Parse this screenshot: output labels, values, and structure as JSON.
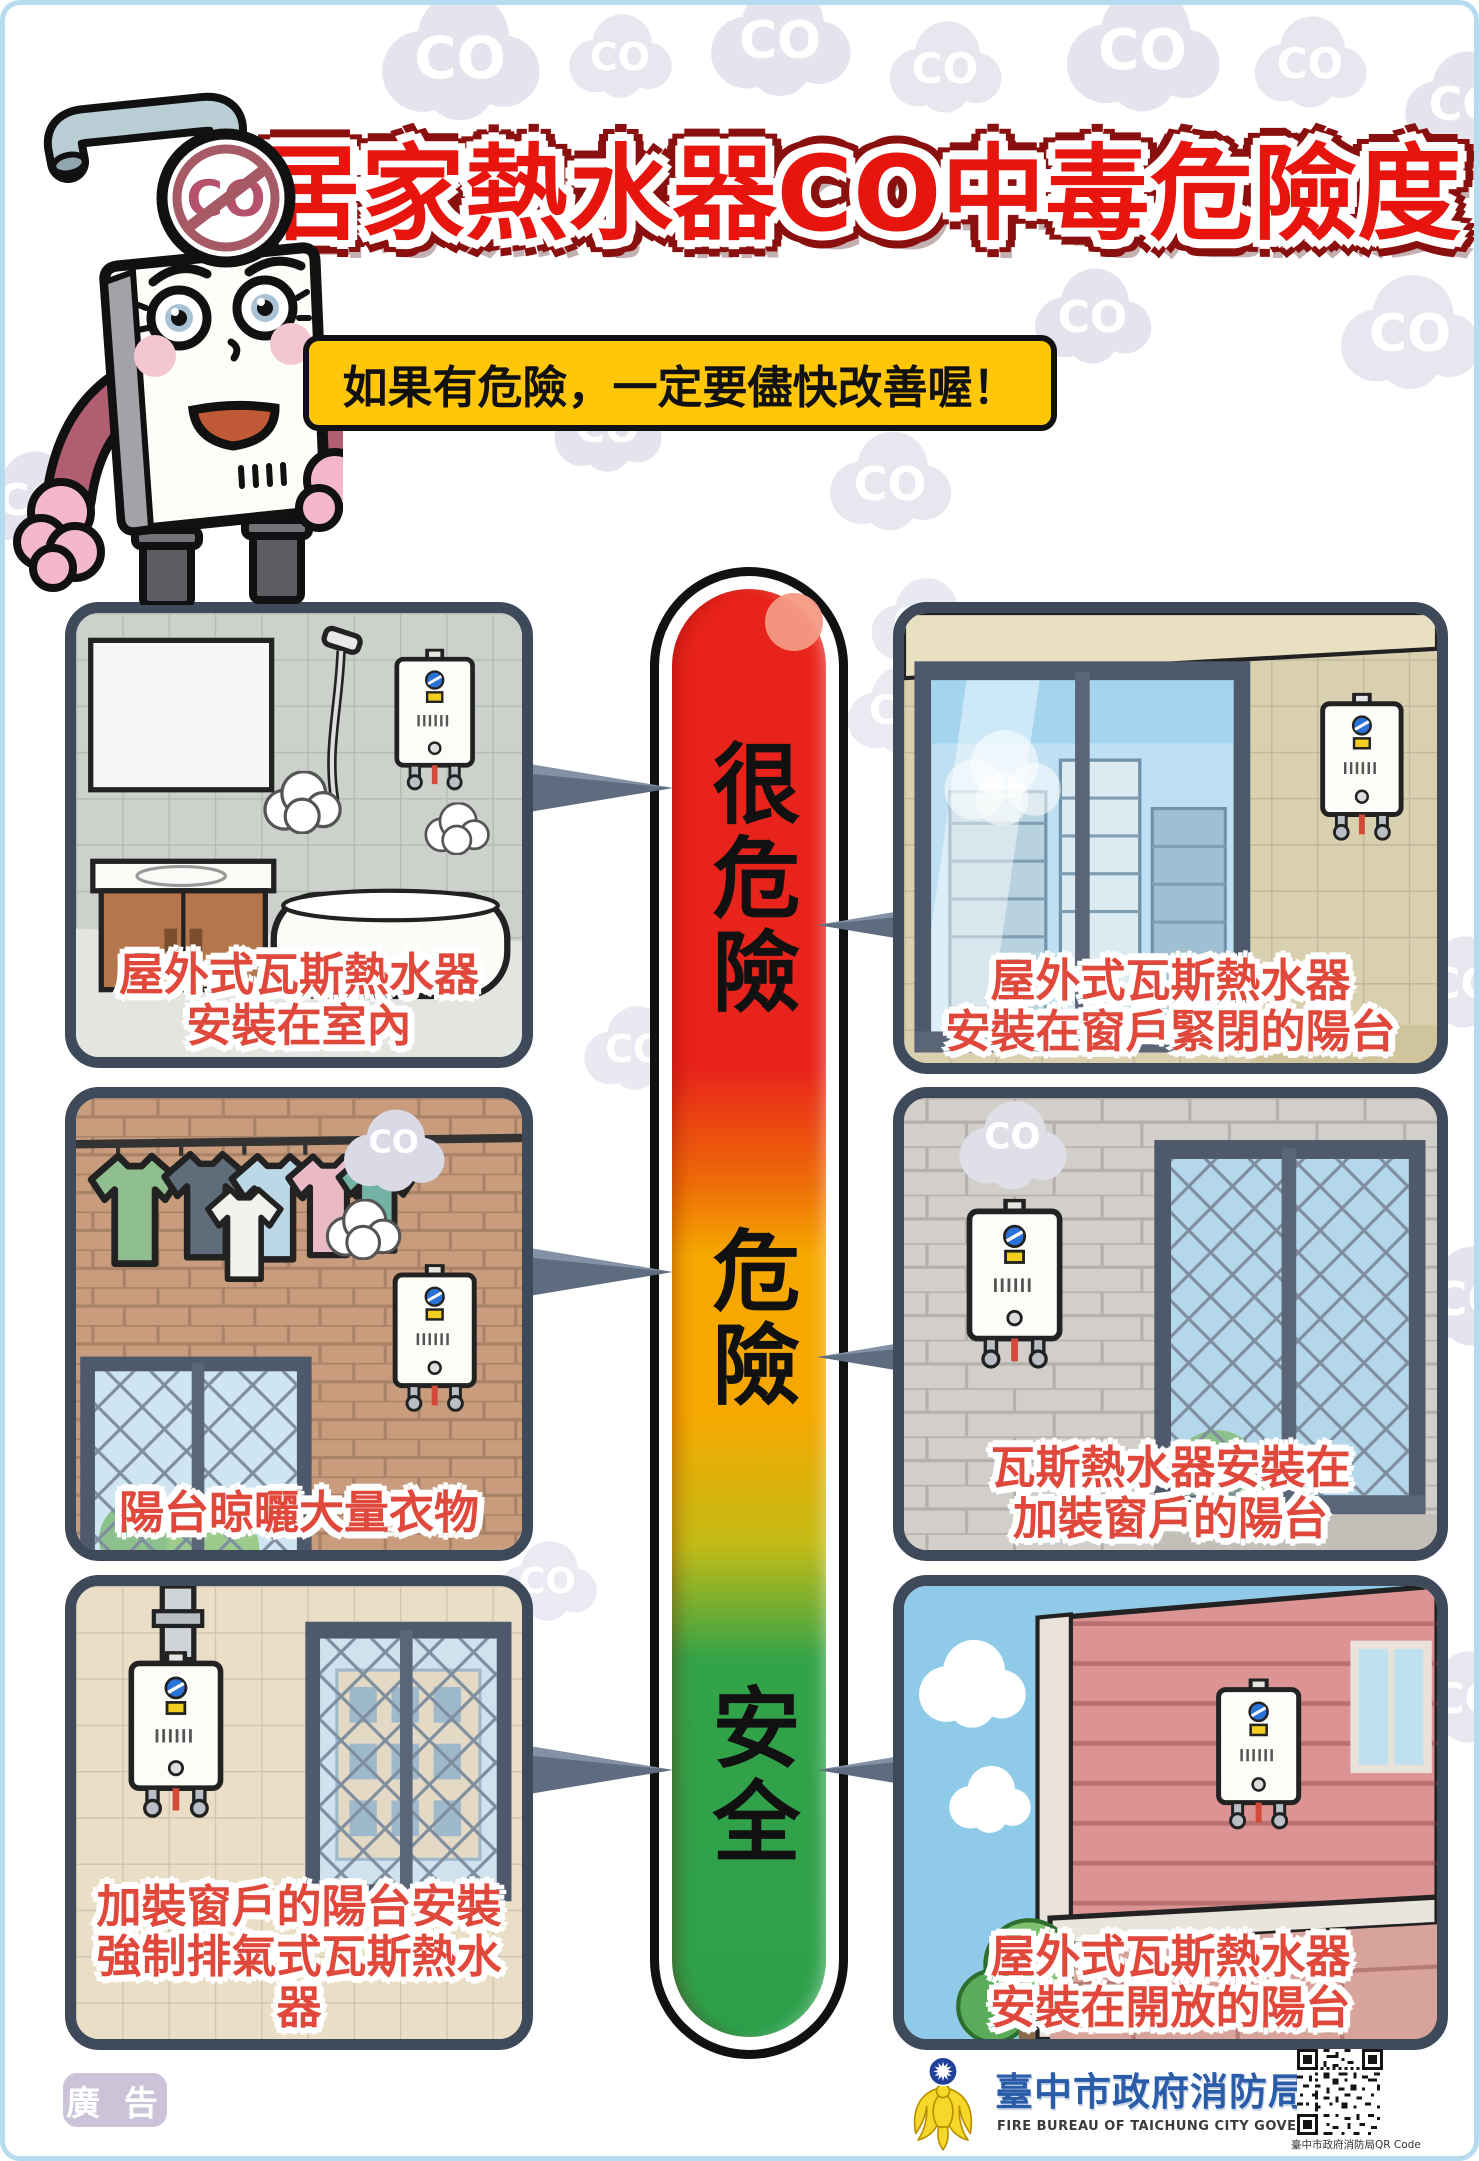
{
  "poster": {
    "title": "居家熱水器CO中毒危險度",
    "speech_bubble": "如果有危險，一定要儘快改善喔！",
    "co_cloud_text": "CO",
    "mascot_badge_text": "CO",
    "ad_label": "廣 告"
  },
  "gauge": {
    "levels": [
      {
        "label": "很危險",
        "color": "#e8231b"
      },
      {
        "label": "危險",
        "color": "#f6a800"
      },
      {
        "label": "安全",
        "color": "#2da04c"
      }
    ]
  },
  "panels": [
    {
      "caption_line1": "屋外式瓦斯熱水器",
      "caption_line2": "安裝在室內",
      "risk": "很危險"
    },
    {
      "caption_line1": "屋外式瓦斯熱水器",
      "caption_line2": "安裝在窗戶緊閉的陽台",
      "risk": "很危險"
    },
    {
      "caption_line1": "陽台晾曬大量衣物",
      "caption_line2": "",
      "risk": "危險"
    },
    {
      "caption_line1": "瓦斯熱水器安裝在",
      "caption_line2": "加裝窗戶的陽台",
      "risk": "危險"
    },
    {
      "caption_line1": "加裝窗戶的陽台安裝",
      "caption_line2": "強制排氣式瓦斯熱水器",
      "risk": "安全"
    },
    {
      "caption_line1": "屋外式瓦斯熱水器",
      "caption_line2": "安裝在開放的陽台",
      "risk": "安全"
    }
  ],
  "footer": {
    "agency_zh": "臺中市政府消防局",
    "agency_en": "FIRE BUREAU OF TAICHUNG CITY GOVERNMENT",
    "qr_caption": "臺中市政府消防局QR Code"
  },
  "colors": {
    "title_red": "#e8150f",
    "bubble_yellow": "#ffc60a",
    "caption_red": "#e0483c",
    "panel_frame": "#3e4a59",
    "gauge_red": "#e8231b",
    "gauge_orange": "#f6a800",
    "gauge_green": "#2da04c",
    "footer_blue": "#2a5ca8",
    "cloud_gray": "#e4e4ee"
  }
}
